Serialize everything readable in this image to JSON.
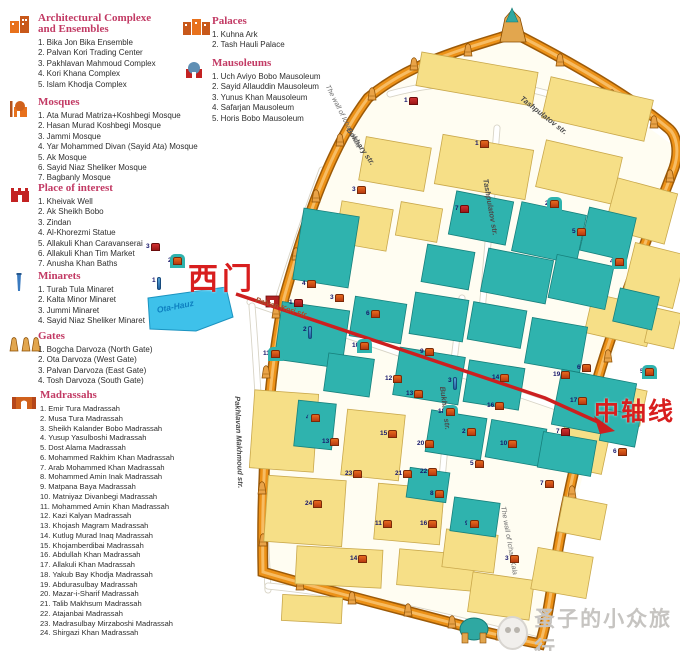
{
  "colors": {
    "legend_title": "#c23a64",
    "wall_orange": "#ec9117",
    "building_yellow": "#f6df87",
    "monument_teal": "#2fb3ae",
    "annotation_red": "#d81e1e",
    "lake_blue": "#3ec1ea"
  },
  "legend": {
    "sections": [
      {
        "id": "complexes",
        "icon": "complex-icon",
        "title": "Architectural Complexe",
        "title2": "and Ensembles",
        "items": [
          "Bika Jon Bika Ensemble",
          "Palvan Kori Trading Center",
          "Pakhlavan Mahmoud Complex",
          "Kori Khana Complex",
          "Islam Khodja Complex"
        ]
      },
      {
        "id": "mosques",
        "icon": "mosque-icon",
        "title": "Mosques",
        "title2": "",
        "items": [
          "Ata Murad Matriza+Koshbegi Mosque",
          "Hasan Murad Koshbegi Mosque",
          "Jammi Mosque",
          "Yar Mohammed Divan (Sayid Ata) Mosque",
          "Ak Mosque",
          "Sayid Niaz Sheliker Mosque",
          "Bagbanly Mosque"
        ]
      },
      {
        "id": "interest",
        "icon": "landmark-icon",
        "title": "Place of interest",
        "title2": "",
        "items": [
          "Kheivak Well",
          "Ak Sheikh Bobo",
          "Zindan",
          "Al-Khorezmi Statue",
          "Allakuli Khan Caravanserai",
          "Allakuli Khan Tim Market",
          "Anusha Khan Baths"
        ]
      },
      {
        "id": "minarets",
        "icon": "minaret-icon",
        "title": "Minarets",
        "title2": "",
        "items": [
          "Turab Tula Minaret",
          "Kalta Minor Minaret",
          "Jummi Minaret",
          "Sayid Niaz Sheliker Minaret"
        ]
      },
      {
        "id": "gates",
        "icon": "gate-icon",
        "title": "Gates",
        "title2": "",
        "items": [
          "Bogcha Darvoza (North Gate)",
          "Ota Darvoza (West Gate)",
          "Palvan Darvoza (East Gate)",
          "Tosh Darvoza (South Gate)"
        ]
      },
      {
        "id": "madrassahs",
        "icon": "madrassah-icon",
        "title": "Madrassahs",
        "title2": "",
        "items": [
          "Emir Tura Madrassah",
          "Musa Tura Madrassah",
          "Sheikh Kalander Bobo Madrassah",
          "Yusup Yasulboshi Madrassah",
          "Dost Alama Madrassah",
          "Mohammed Rakhim Khan Madrassah",
          "Arab Mohammed Khan Madrassah",
          "Mohammed Amin Inak Madrassah",
          "Matpana Baya Madrassah",
          "Matniyaz Divanbegi Madrassah",
          "Mohammed Amin Khan Madrassah",
          "Kazi Kalyan Madrassah",
          "Khojash Magram Madrassah",
          "Kutlug Murad Inaq Madrassah",
          "Khojamberdibai Madrassah",
          "Abdullah Khan Madrassah",
          "Allakuli Khan Madrassah",
          "Yakub Bay Khodja Madrassah",
          "Abdurasulbay Madrassah",
          "Mazar-i-Sharif Madrassah",
          "Talib Makhsum Madrassah",
          "Atajanbai Madrassah",
          "Madrasulbay Mirzaboshi Madrassah",
          "Shirgazi Khan Madrassah"
        ]
      },
      {
        "id": "palaces",
        "icon": "palace-icon",
        "title": "Palaces",
        "title2": "",
        "items": [
          "Kuhna Ark",
          "Tash Hauli Palace"
        ]
      },
      {
        "id": "mausoleums",
        "icon": "mausoleum-icon",
        "title": "Mausoleums",
        "title2": "",
        "items": [
          "Uch Aviyo Bobo Mausoleum",
          "Sayid Allauddin Mausoleum",
          "Yunus Khan Mausoleum",
          "Safarjan Mausoleum",
          "Horis Bobo Mausoleum"
        ]
      }
    ]
  },
  "map": {
    "annotations": {
      "west_gate_label": "西门",
      "axis_label": "中轴线"
    },
    "wall_label": "The wall of Ichan-Kala",
    "lake_label": "Ota-Hauz",
    "wall_labels_pos": [
      {
        "x": 330,
        "y": 84,
        "rot": 63
      },
      {
        "x": 506,
        "y": 506,
        "rot": 80
      }
    ],
    "lake_label_pos": {
      "x": 156,
      "y": 305,
      "rot": -11
    },
    "street_labels": [
      {
        "text": "Tashpulatov str.",
        "x": 524,
        "y": 94,
        "rot": 38,
        "cls": ""
      },
      {
        "text": "Tashpulatov str.",
        "x": 490,
        "y": 178,
        "rot": 80,
        "cls": ""
      },
      {
        "text": "Bokhary str.",
        "x": 352,
        "y": 126,
        "rot": 55,
        "cls": ""
      },
      {
        "text": "Bukhara str.",
        "x": 447,
        "y": 386,
        "rot": 83,
        "cls": ""
      },
      {
        "text": "Palvan Kori str.",
        "x": 257,
        "y": 295,
        "rot": 17,
        "cls": "brown"
      },
      {
        "text": "Pakhlavan Makhmoud str.",
        "x": 242,
        "y": 396,
        "rot": 88,
        "cls": ""
      }
    ],
    "markers": [
      [
        3,
        146,
        243,
        "r"
      ],
      [
        2,
        168,
        257,
        "t"
      ],
      [
        1,
        152,
        277,
        "b"
      ],
      [
        1,
        404,
        97,
        "r"
      ],
      [
        1,
        475,
        140,
        "o"
      ],
      [
        3,
        352,
        186,
        "o"
      ],
      [
        7,
        455,
        205,
        "r"
      ],
      [
        2,
        545,
        200,
        "t"
      ],
      [
        5,
        572,
        228,
        "o"
      ],
      [
        4,
        610,
        258,
        "t"
      ],
      [
        1,
        289,
        299,
        "r"
      ],
      [
        3,
        330,
        294,
        "o"
      ],
      [
        4,
        302,
        280,
        "o"
      ],
      [
        6,
        366,
        310,
        "o"
      ],
      [
        2,
        303,
        326,
        "b"
      ],
      [
        10,
        352,
        342,
        "t"
      ],
      [
        11,
        263,
        350,
        "t"
      ],
      [
        9,
        420,
        348,
        "o"
      ],
      [
        12,
        385,
        375,
        "o"
      ],
      [
        14,
        492,
        374,
        "o"
      ],
      [
        3,
        448,
        377,
        "b"
      ],
      [
        16,
        487,
        402,
        "o"
      ],
      [
        13,
        406,
        390,
        "o"
      ],
      [
        18,
        438,
        408,
        "t"
      ],
      [
        20,
        417,
        440,
        "o"
      ],
      [
        22,
        420,
        468,
        "o"
      ],
      [
        2,
        462,
        428,
        "o"
      ],
      [
        19,
        553,
        371,
        "o"
      ],
      [
        6,
        577,
        364,
        "o"
      ],
      [
        17,
        570,
        397,
        "o"
      ],
      [
        7,
        556,
        428,
        "r"
      ],
      [
        6,
        613,
        448,
        "o"
      ],
      [
        5,
        640,
        368,
        "t"
      ],
      [
        4,
        306,
        414,
        "t"
      ],
      [
        13,
        322,
        438,
        "o"
      ],
      [
        23,
        345,
        470,
        "o"
      ],
      [
        24,
        305,
        500,
        "o"
      ],
      [
        15,
        380,
        430,
        "o"
      ],
      [
        21,
        395,
        470,
        "o"
      ],
      [
        8,
        430,
        490,
        "o"
      ],
      [
        5,
        470,
        460,
        "o"
      ],
      [
        10,
        500,
        440,
        "o"
      ],
      [
        16,
        420,
        520,
        "o"
      ],
      [
        9,
        465,
        520,
        "t"
      ],
      [
        11,
        375,
        520,
        "o"
      ],
      [
        3,
        505,
        555,
        "o"
      ],
      [
        14,
        350,
        555,
        "o"
      ],
      [
        7,
        540,
        480,
        "o"
      ]
    ]
  },
  "watermark": {
    "text": "蚤子的小众旅行"
  }
}
